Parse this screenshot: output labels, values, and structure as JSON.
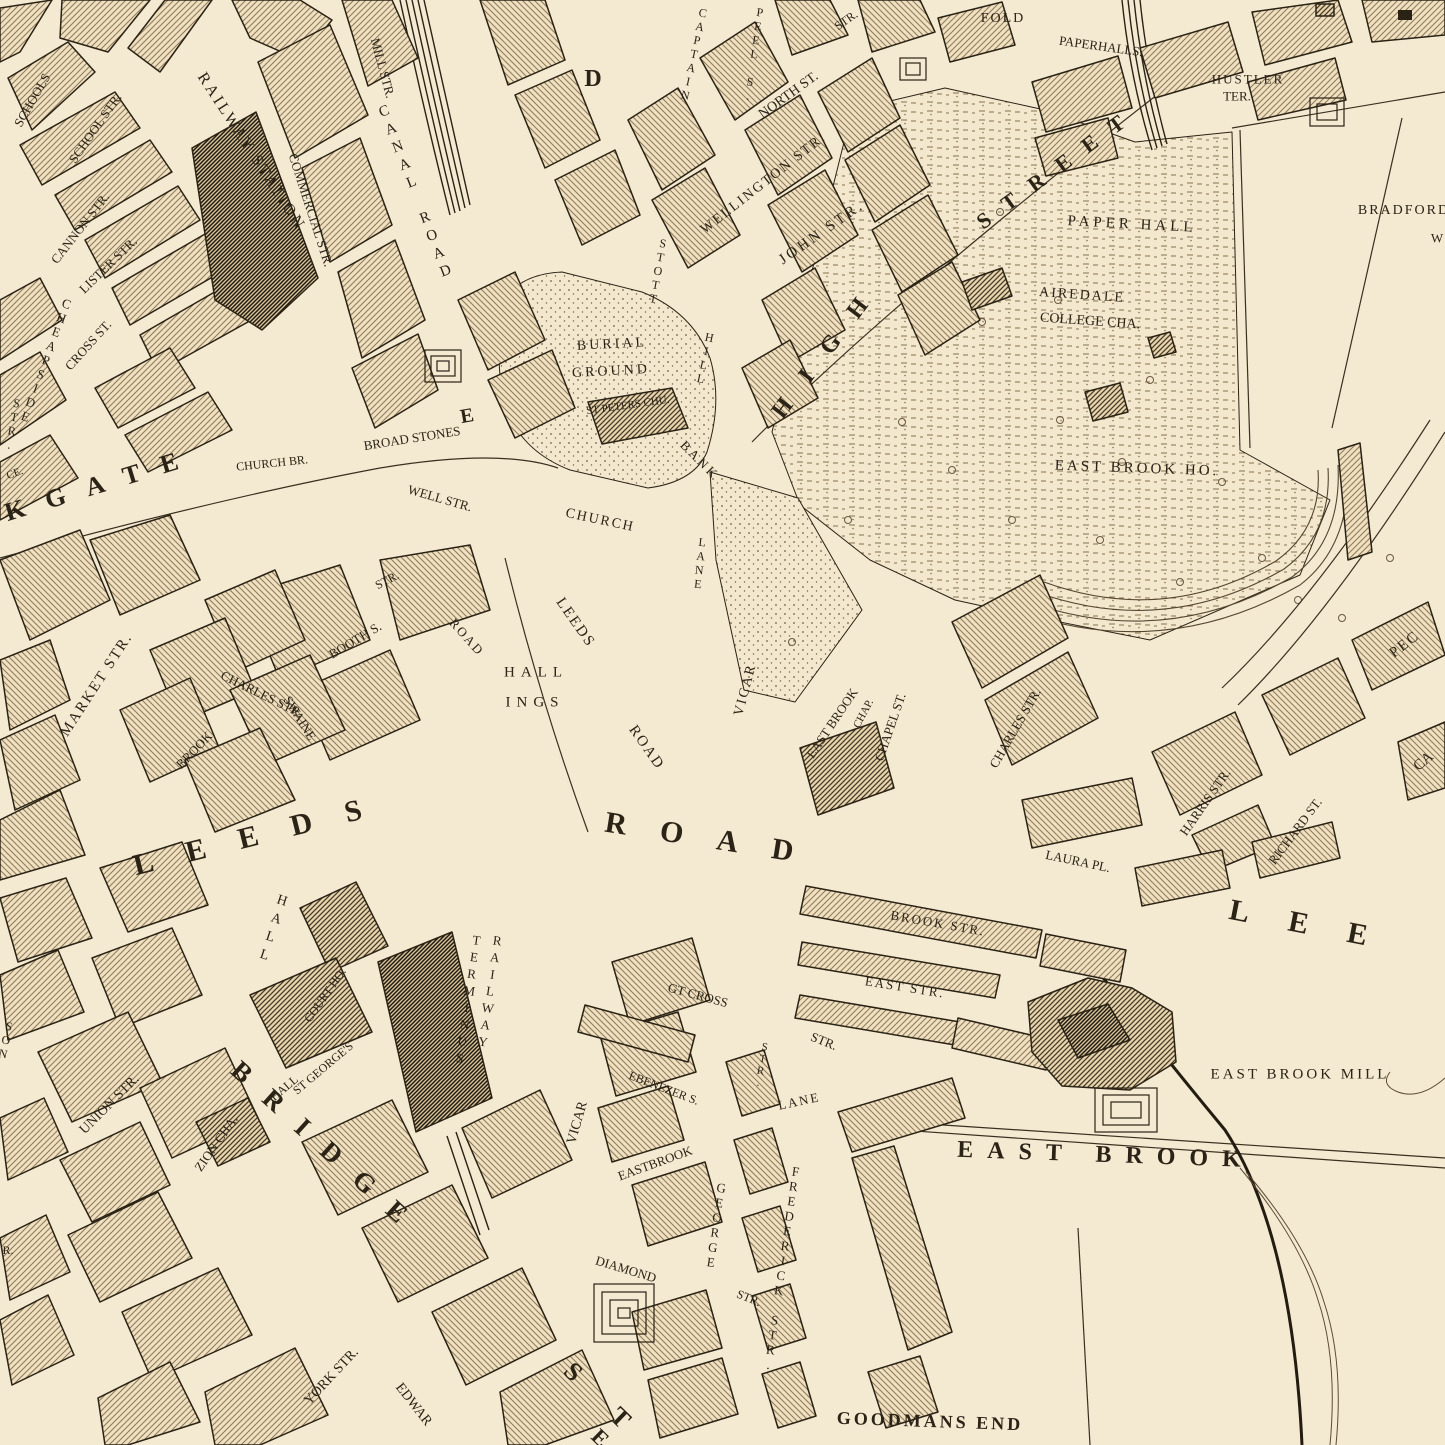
{
  "style": {
    "paper": "#f4e9d1",
    "ink": "#2b2316",
    "hatch_light": "#8d7857",
    "hatch_dark": "#463a28",
    "hatch_black": "#221b10",
    "water": "#5b4b35"
  },
  "labels": [
    {
      "t": "SCHOOLS",
      "x": 32,
      "y": 100,
      "r": -60,
      "s": 13
    },
    {
      "t": "SCHOOL STR.",
      "x": 95,
      "y": 128,
      "r": -55,
      "s": 13
    },
    {
      "t": "CANNON STR.",
      "x": 80,
      "y": 228,
      "r": -52,
      "s": 13
    },
    {
      "t": "LISTER STR.",
      "x": 108,
      "y": 265,
      "r": -44,
      "s": 13
    },
    {
      "t": "CROSS ST.",
      "x": 88,
      "y": 345,
      "r": -48,
      "s": 13
    },
    {
      "t": "CHEAPSIDE",
      "x": 46,
      "y": 360,
      "r": 20,
      "v": 1,
      "s": 13
    },
    {
      "t": "STR.",
      "x": 13,
      "y": 424,
      "r": 10,
      "v": 1,
      "s": 12
    },
    {
      "t": "RAILWAY STATION",
      "x": 251,
      "y": 152,
      "r": 57,
      "s": 16,
      "ls": 3
    },
    {
      "t": "COMMERCIAL STR.",
      "x": 311,
      "y": 210,
      "r": 72,
      "s": 13
    },
    {
      "t": "MILL STR.",
      "x": 383,
      "y": 68,
      "r": 75,
      "s": 13
    },
    {
      "t": "CANAL ROAD",
      "x": 415,
      "y": 193,
      "r": -21,
      "v": 1,
      "s": 15,
      "ls": 3
    },
    {
      "t": "D",
      "x": 593,
      "y": 79,
      "s": 24,
      "w": 700
    },
    {
      "t": "CAPTAIN",
      "x": 694,
      "y": 54,
      "r": 12,
      "v": 1,
      "s": 12
    },
    {
      "t": "PEEL S.",
      "x": 754,
      "y": 54,
      "r": 8,
      "v": 1,
      "s": 12
    },
    {
      "t": "STR.",
      "x": 846,
      "y": 20,
      "r": -35,
      "s": 12
    },
    {
      "t": "NORTH ST.",
      "x": 789,
      "y": 96,
      "r": -36,
      "s": 14
    },
    {
      "t": "WELLINGTON STR.",
      "x": 764,
      "y": 184,
      "r": -38,
      "s": 14,
      "ls": 2
    },
    {
      "t": "JOHN STR.",
      "x": 822,
      "y": 233,
      "r": -35,
      "s": 15,
      "ls": 3
    },
    {
      "t": "HIGH",
      "x": 828,
      "y": 348,
      "r": -53,
      "s": 24,
      "ls": 26,
      "w": 700
    },
    {
      "t": "STREET",
      "x": 1058,
      "y": 167,
      "r": -36,
      "s": 22,
      "ls": 18,
      "w": 700
    },
    {
      "t": "STOTT",
      "x": 658,
      "y": 271,
      "r": 10,
      "v": 1,
      "s": 12
    },
    {
      "t": "HILL",
      "x": 705,
      "y": 358,
      "r": 12,
      "v": 1,
      "s": 12
    },
    {
      "t": "BURIAL",
      "x": 612,
      "y": 345,
      "r": -3,
      "s": 14,
      "ls": 3
    },
    {
      "t": "GROUND",
      "x": 611,
      "y": 372,
      "r": -3,
      "s": 14,
      "ls": 3
    },
    {
      "t": "ST PETERS CHU.",
      "x": 628,
      "y": 406,
      "r": -8,
      "s": 11
    },
    {
      "t": "CHURCH",
      "x": 600,
      "y": 521,
      "r": 12,
      "s": 14,
      "ls": 2
    },
    {
      "t": "BANK",
      "x": 700,
      "y": 460,
      "r": 45,
      "s": 13,
      "ls": 3
    },
    {
      "t": "CHURCH BR.",
      "x": 272,
      "y": 463,
      "r": -6,
      "s": 12
    },
    {
      "t": "BROAD STONES",
      "x": 412,
      "y": 438,
      "r": -9,
      "s": 13
    },
    {
      "t": "WELL STR.",
      "x": 440,
      "y": 498,
      "r": 16,
      "s": 13
    },
    {
      "t": "E",
      "x": 467,
      "y": 416,
      "r": -10,
      "s": 20,
      "w": 700
    },
    {
      "t": "KGATE",
      "x": 102,
      "y": 484,
      "r": -17,
      "s": 26,
      "ls": 22,
      "w": 700
    },
    {
      "t": "LEEDS",
      "x": 575,
      "y": 623,
      "r": 55,
      "s": 15,
      "ls": 2
    },
    {
      "t": "ROAD",
      "x": 646,
      "y": 748,
      "r": 55,
      "s": 15,
      "ls": 2
    },
    {
      "t": "HALL",
      "x": 536,
      "y": 673,
      "s": 15,
      "ls": 6
    },
    {
      "t": "INGS",
      "x": 535,
      "y": 703,
      "s": 15,
      "ls": 6
    },
    {
      "t": "LANE",
      "x": 700,
      "y": 563,
      "r": 6,
      "v": 1,
      "s": 12
    },
    {
      "t": "VICAR",
      "x": 746,
      "y": 690,
      "r": -75,
      "s": 14,
      "ls": 2
    },
    {
      "t": "EAST BROOK",
      "x": 832,
      "y": 723,
      "r": -56,
      "s": 13
    },
    {
      "t": "CHAP.",
      "x": 864,
      "y": 714,
      "r": -62,
      "s": 11
    },
    {
      "t": "CHAPEL ST.",
      "x": 890,
      "y": 727,
      "r": -71,
      "s": 13
    },
    {
      "t": "CHARLES STR.",
      "x": 1015,
      "y": 728,
      "r": -60,
      "s": 13
    },
    {
      "t": "BOOTH S.",
      "x": 355,
      "y": 640,
      "r": -31,
      "s": 13
    },
    {
      "t": "STR.",
      "x": 387,
      "y": 580,
      "r": -28,
      "s": 12
    },
    {
      "t": "ROAD",
      "x": 467,
      "y": 637,
      "r": 48,
      "s": 13,
      "ls": 2
    },
    {
      "t": "MARKET STR.",
      "x": 97,
      "y": 685,
      "r": -57,
      "s": 15,
      "ls": 2
    },
    {
      "t": "CHARLES STR.",
      "x": 262,
      "y": 694,
      "r": 26,
      "s": 13
    },
    {
      "t": "BROOK",
      "x": 194,
      "y": 750,
      "r": -46,
      "s": 13
    },
    {
      "t": "SWAINE",
      "x": 300,
      "y": 718,
      "r": 58,
      "s": 13
    },
    {
      "t": "LEEDS",
      "x": 264,
      "y": 834,
      "r": -14,
      "s": 30,
      "ls": 34,
      "w": 700
    },
    {
      "t": "ROAD",
      "x": 716,
      "y": 840,
      "r": 9,
      "s": 30,
      "ls": 34,
      "w": 700
    },
    {
      "t": "LEE",
      "x": 1318,
      "y": 927,
      "r": 11,
      "s": 30,
      "ls": 40,
      "w": 700
    },
    {
      "t": "HALL",
      "x": 272,
      "y": 930,
      "r": 18,
      "v": 1,
      "s": 14,
      "ls": 4
    },
    {
      "t": "COURT HO.",
      "x": 325,
      "y": 995,
      "r": -55,
      "s": 12
    },
    {
      "t": "ST GEORGE'S",
      "x": 323,
      "y": 1068,
      "r": -40,
      "s": 12
    },
    {
      "t": "HALL",
      "x": 284,
      "y": 1088,
      "r": -40,
      "s": 12
    },
    {
      "t": "TERMINUS",
      "x": 468,
      "y": 1000,
      "r": 8,
      "v": 1,
      "s": 13,
      "ls": 2
    },
    {
      "t": "RAILWAY",
      "x": 490,
      "y": 992,
      "r": 8,
      "v": 1,
      "s": 13,
      "ls": 2
    },
    {
      "t": "BRIDGE",
      "x": 328,
      "y": 1150,
      "r": 42,
      "s": 27,
      "ls": 24,
      "w": 700
    },
    {
      "t": "S",
      "x": 573,
      "y": 1372,
      "r": 44,
      "s": 26,
      "w": 700
    },
    {
      "t": "T",
      "x": 620,
      "y": 1418,
      "r": 44,
      "s": 26,
      "w": 700
    },
    {
      "t": "E",
      "x": 600,
      "y": 1438,
      "r": 44,
      "s": 22,
      "w": 700
    },
    {
      "t": "UNION STR.",
      "x": 110,
      "y": 1105,
      "r": -45,
      "s": 14
    },
    {
      "t": "ZION CHA.",
      "x": 216,
      "y": 1143,
      "r": -55,
      "s": 13
    },
    {
      "t": "SON",
      "x": 6,
      "y": 1040,
      "r": 12,
      "v": 1,
      "s": 12
    },
    {
      "t": "R.",
      "x": 8,
      "y": 1250,
      "s": 12
    },
    {
      "t": "CE.",
      "x": 15,
      "y": 474,
      "r": -20,
      "s": 11
    },
    {
      "t": "YORK STR.",
      "x": 332,
      "y": 1377,
      "r": -47,
      "s": 14
    },
    {
      "t": "EDWAR",
      "x": 413,
      "y": 1405,
      "r": 52,
      "s": 14
    },
    {
      "t": "VICAR",
      "x": 578,
      "y": 1123,
      "r": -74,
      "s": 14
    },
    {
      "t": "EBENEZER S.",
      "x": 664,
      "y": 1088,
      "r": 21,
      "s": 12
    },
    {
      "t": "GT CROSS",
      "x": 698,
      "y": 995,
      "r": 15,
      "s": 13
    },
    {
      "t": "STR.",
      "x": 824,
      "y": 1041,
      "r": 22,
      "s": 13
    },
    {
      "t": "STR.",
      "x": 761,
      "y": 1065,
      "r": 10,
      "v": 1,
      "s": 11
    },
    {
      "t": "EAST STR.",
      "x": 905,
      "y": 987,
      "r": 9,
      "s": 13,
      "ls": 2
    },
    {
      "t": "BROOK STR.",
      "x": 938,
      "y": 923,
      "r": 10,
      "s": 13,
      "ls": 2
    },
    {
      "t": "EASTBROOK",
      "x": 655,
      "y": 1163,
      "r": -20,
      "s": 13
    },
    {
      "t": "LANE",
      "x": 799,
      "y": 1101,
      "r": -12,
      "s": 13,
      "ls": 2
    },
    {
      "t": "DIAMOND",
      "x": 626,
      "y": 1269,
      "r": 17,
      "s": 13
    },
    {
      "t": "STR.",
      "x": 749,
      "y": 1298,
      "r": 22,
      "s": 12
    },
    {
      "t": "GEORGE",
      "x": 716,
      "y": 1225,
      "r": 8,
      "v": 1,
      "s": 13
    },
    {
      "t": "FREDERICK STR.",
      "x": 782,
      "y": 1268,
      "r": 8,
      "v": 1,
      "s": 13
    },
    {
      "t": "EAST BROOK MILL",
      "x": 1300,
      "y": 1075,
      "s": 15,
      "ls": 3
    },
    {
      "t": "EAST BROOK",
      "x": 1106,
      "y": 1155,
      "r": 2,
      "s": 24,
      "ls": 14,
      "w": 700
    },
    {
      "t": "GOODMANS END",
      "x": 930,
      "y": 1421,
      "r": 2,
      "s": 18,
      "ls": 3,
      "w": 700
    },
    {
      "t": "FOLD",
      "x": 1003,
      "y": 19,
      "s": 14,
      "ls": 2
    },
    {
      "t": "PAPERHALLS.",
      "x": 1101,
      "y": 46,
      "r": 8,
      "s": 13
    },
    {
      "t": "HUSTLER",
      "x": 1248,
      "y": 79,
      "s": 13,
      "ls": 2
    },
    {
      "t": "TER.",
      "x": 1237,
      "y": 96,
      "s": 13
    },
    {
      "t": "PAPER HALL",
      "x": 1132,
      "y": 225,
      "r": 3,
      "s": 15,
      "ls": 4
    },
    {
      "t": "AIREDALE",
      "x": 1082,
      "y": 296,
      "r": 4,
      "s": 14,
      "ls": 2
    },
    {
      "t": "COLLEGE CHA.",
      "x": 1090,
      "y": 322,
      "r": 4,
      "s": 14
    },
    {
      "t": "EAST BROOK HO.",
      "x": 1137,
      "y": 469,
      "r": 2,
      "s": 15,
      "ls": 3
    },
    {
      "t": "BRADFORD",
      "x": 1404,
      "y": 211,
      "s": 14,
      "ls": 2
    },
    {
      "t": "W",
      "x": 1437,
      "y": 238,
      "s": 13
    },
    {
      "t": "PEC",
      "x": 1405,
      "y": 645,
      "r": -38,
      "s": 15,
      "ls": 2
    },
    {
      "t": "CA",
      "x": 1424,
      "y": 762,
      "r": -40,
      "s": 15
    },
    {
      "t": "LAURA PL.",
      "x": 1078,
      "y": 861,
      "r": 12,
      "s": 13
    },
    {
      "t": "HARRIS STR.",
      "x": 1205,
      "y": 802,
      "r": -55,
      "s": 13
    },
    {
      "t": "RICHARD ST.",
      "x": 1295,
      "y": 831,
      "r": -53,
      "s": 13
    }
  ]
}
